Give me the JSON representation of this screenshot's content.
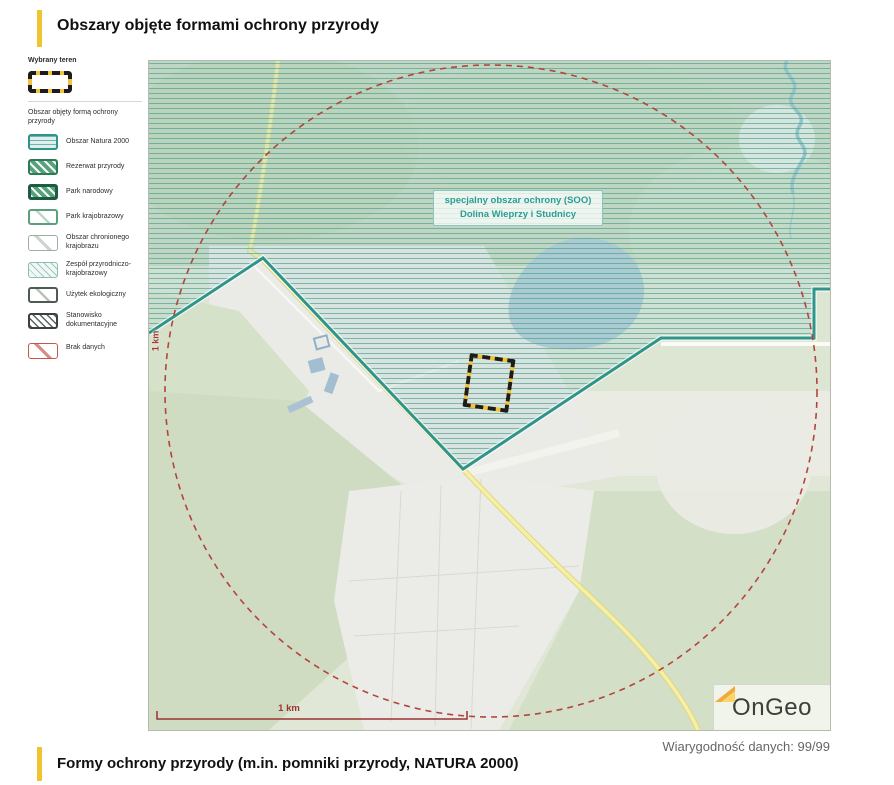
{
  "header": {
    "title": "Obszary objęte formami ochrony przyrody"
  },
  "legend": {
    "selected_heading": "Wybrany teren",
    "group_heading": "Obszar objęty formą ochrony przyrody",
    "items": [
      {
        "label": "Obszar Natura 2000",
        "type": "natura-2000"
      },
      {
        "label": "Rezerwat przyrody",
        "type": "rezerwat-przyrody"
      },
      {
        "label": "Park narodowy",
        "type": "park-narodowy"
      },
      {
        "label": "Park krajobrazowy",
        "type": "park-krajobrazowy"
      },
      {
        "label": "Obszar chronionego krajobrazu",
        "type": "obszar-chronionego-krajobrazu"
      },
      {
        "label": "Zespół przyrodniczo-krajobrazowy",
        "type": "zespol-przyrodniczo-krajobrazowy"
      },
      {
        "label": "Użytek ekologiczny",
        "type": "uzytek-ekologiczny"
      },
      {
        "label": "Stanowisko dokumentacyjne",
        "type": "stanowisko-dokumentacyjne"
      },
      {
        "label": "Brak danych",
        "type": "brak-danych"
      }
    ]
  },
  "map": {
    "area_label": {
      "line1": "specjalny obszar ochrony (SOO)",
      "line2": "Dolina Wieprzy i Studnicy"
    },
    "radius_label": "1 km",
    "scale_bar_label": "1 km",
    "logo_text": "OnGeo"
  },
  "footer": {
    "title": "Formy ochrony przyrody (m.in. pomniki przyrody, NATURA 2000)",
    "data_reliability": "Wiarygodność danych: 99/99"
  },
  "colors": {
    "accent_yellow": "#f0c330",
    "natura_teal": "#2f958a",
    "selected_area_yellow": "#f3c235",
    "buffer_circle_red": "#b2453e",
    "scale_bar_red": "#993333",
    "lake_blue": "#a9c6d2"
  }
}
